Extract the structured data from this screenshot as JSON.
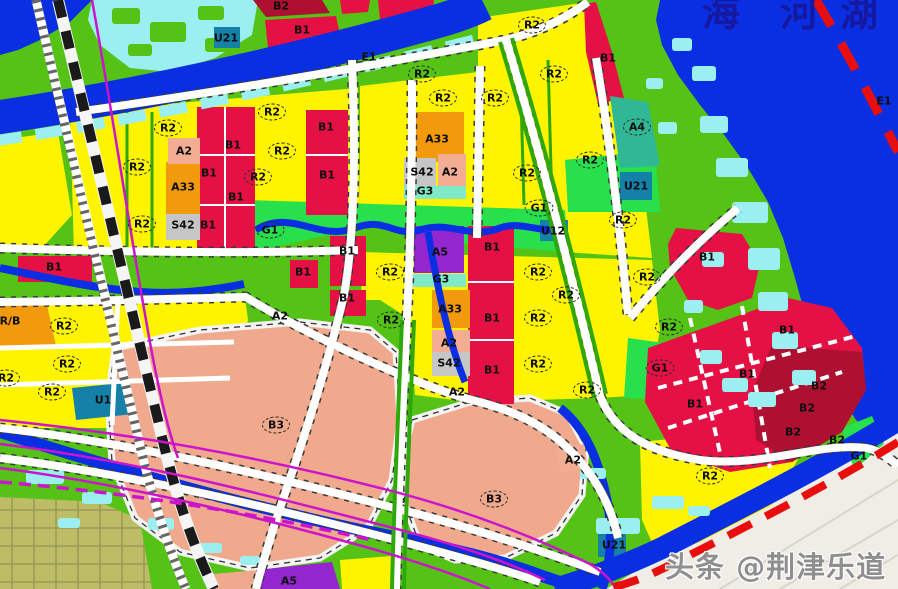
{
  "map": {
    "watermark": "头条 @荆津乐道",
    "lake": {
      "name_chars": [
        "海",
        "河",
        "湖"
      ]
    },
    "palette": {
      "residential_R2": "#FEF400",
      "commercial_B1": "#E51144",
      "commercial_B2": "#AD1030",
      "recreation_B3": "#F0A98C",
      "culture_A2": "#F3AD92",
      "education_A33": "#F29A0D",
      "sports_A4": "#30B896",
      "special_A5": "#9326CE",
      "parking_S42": "#C6C6C6",
      "park_G1": "#28E04C",
      "green_G3": "#7FE9C8",
      "utility_U": "#1580A8",
      "water_E1": "#0A2FE2",
      "pond_cyan": "#9CEFF0",
      "land_green": "#54C316",
      "farmland_khaki": "#BDBD68",
      "boundary_red": "#E80E0E",
      "utility_magenta": "#CC14CC"
    },
    "zone_labels": [
      {
        "text": "B2",
        "x": 281,
        "y": 6
      },
      {
        "text": "B1",
        "x": 302,
        "y": 30
      },
      {
        "text": "U21",
        "x": 226,
        "y": 38
      },
      {
        "text": "E1",
        "x": 369,
        "y": 57
      },
      {
        "text": "R2",
        "x": 532,
        "y": 25,
        "circled": true
      },
      {
        "text": "R2",
        "x": 422,
        "y": 74,
        "circled": true
      },
      {
        "text": "R2",
        "x": 554,
        "y": 74,
        "circled": true
      },
      {
        "text": "B1",
        "x": 608,
        "y": 58
      },
      {
        "text": "A4",
        "x": 637,
        "y": 127,
        "circled": true
      },
      {
        "text": "R2",
        "x": 272,
        "y": 112,
        "circled": true
      },
      {
        "text": "R2",
        "x": 168,
        "y": 128,
        "circled": true
      },
      {
        "text": "B1",
        "x": 233,
        "y": 145
      },
      {
        "text": "A2",
        "x": 184,
        "y": 151
      },
      {
        "text": "R2",
        "x": 282,
        "y": 151,
        "circled": true
      },
      {
        "text": "B1",
        "x": 326,
        "y": 127
      },
      {
        "text": "R2",
        "x": 137,
        "y": 167,
        "circled": true
      },
      {
        "text": "B1",
        "x": 209,
        "y": 173
      },
      {
        "text": "A33",
        "x": 183,
        "y": 187
      },
      {
        "text": "R2",
        "x": 258,
        "y": 177,
        "circled": true
      },
      {
        "text": "B1",
        "x": 236,
        "y": 197
      },
      {
        "text": "B1",
        "x": 327,
        "y": 175
      },
      {
        "text": "R2",
        "x": 443,
        "y": 98,
        "circled": true
      },
      {
        "text": "R2",
        "x": 495,
        "y": 98,
        "circled": true
      },
      {
        "text": "A33",
        "x": 437,
        "y": 139
      },
      {
        "text": "S42",
        "x": 422,
        "y": 172
      },
      {
        "text": "A2",
        "x": 450,
        "y": 172
      },
      {
        "text": "G3",
        "x": 425,
        "y": 191
      },
      {
        "text": "R2",
        "x": 527,
        "y": 173,
        "circled": true
      },
      {
        "text": "R2",
        "x": 590,
        "y": 160,
        "circled": true
      },
      {
        "text": "U21",
        "x": 636,
        "y": 186
      },
      {
        "text": "E1",
        "x": 884,
        "y": 101
      },
      {
        "text": "R2",
        "x": 142,
        "y": 224,
        "circled": true
      },
      {
        "text": "S42",
        "x": 183,
        "y": 225
      },
      {
        "text": "B1",
        "x": 208,
        "y": 225
      },
      {
        "text": "G1",
        "x": 270,
        "y": 230,
        "circled": true
      },
      {
        "text": "G1",
        "x": 539,
        "y": 208,
        "circled": true
      },
      {
        "text": "U12",
        "x": 553,
        "y": 231
      },
      {
        "text": "R2",
        "x": 623,
        "y": 220,
        "circled": true
      },
      {
        "text": "B1",
        "x": 54,
        "y": 267
      },
      {
        "text": "B1",
        "x": 303,
        "y": 272
      },
      {
        "text": "B1",
        "x": 347,
        "y": 251
      },
      {
        "text": "A5",
        "x": 440,
        "y": 252
      },
      {
        "text": "B1",
        "x": 492,
        "y": 247
      },
      {
        "text": "R2",
        "x": 390,
        "y": 272,
        "circled": true
      },
      {
        "text": "R2",
        "x": 538,
        "y": 272,
        "circled": true
      },
      {
        "text": "R2",
        "x": 647,
        "y": 277,
        "circled": true
      },
      {
        "text": "G3",
        "x": 441,
        "y": 279
      },
      {
        "text": "B1",
        "x": 707,
        "y": 257
      },
      {
        "text": "B1",
        "x": 347,
        "y": 298
      },
      {
        "text": "A33",
        "x": 450,
        "y": 309
      },
      {
        "text": "R2",
        "x": 391,
        "y": 320,
        "circled": true
      },
      {
        "text": "B1",
        "x": 492,
        "y": 318
      },
      {
        "text": "R2",
        "x": 538,
        "y": 318,
        "circled": true
      },
      {
        "text": "R2",
        "x": 566,
        "y": 295,
        "circled": true
      },
      {
        "text": "R/B",
        "x": 10,
        "y": 321
      },
      {
        "text": "R2",
        "x": 64,
        "y": 326,
        "circled": true
      },
      {
        "text": "A2",
        "x": 280,
        "y": 316
      },
      {
        "text": "A2",
        "x": 449,
        "y": 343
      },
      {
        "text": "S42",
        "x": 449,
        "y": 363
      },
      {
        "text": "B1",
        "x": 492,
        "y": 370
      },
      {
        "text": "R2",
        "x": 538,
        "y": 364,
        "circled": true
      },
      {
        "text": "R2",
        "x": 587,
        "y": 390,
        "circled": true
      },
      {
        "text": "R2",
        "x": 669,
        "y": 327,
        "circled": true
      },
      {
        "text": "G1",
        "x": 660,
        "y": 368,
        "circled": true
      },
      {
        "text": "B1",
        "x": 787,
        "y": 330
      },
      {
        "text": "R2",
        "x": 67,
        "y": 364,
        "circled": true
      },
      {
        "text": "R2",
        "x": 6,
        "y": 378,
        "circled": true
      },
      {
        "text": "R2",
        "x": 52,
        "y": 392,
        "circled": true
      },
      {
        "text": "U1",
        "x": 103,
        "y": 400
      },
      {
        "text": "B3",
        "x": 276,
        "y": 425,
        "circled": true
      },
      {
        "text": "A2",
        "x": 457,
        "y": 392
      },
      {
        "text": "B1",
        "x": 747,
        "y": 374
      },
      {
        "text": "B2",
        "x": 819,
        "y": 386
      },
      {
        "text": "B1",
        "x": 695,
        "y": 404
      },
      {
        "text": "B2",
        "x": 807,
        "y": 408
      },
      {
        "text": "B2",
        "x": 793,
        "y": 432
      },
      {
        "text": "B2",
        "x": 837,
        "y": 440
      },
      {
        "text": "G1",
        "x": 859,
        "y": 456
      },
      {
        "text": "A2",
        "x": 573,
        "y": 460
      },
      {
        "text": "R2",
        "x": 710,
        "y": 476,
        "circled": true
      },
      {
        "text": "B3",
        "x": 494,
        "y": 499,
        "circled": true
      },
      {
        "text": "U21",
        "x": 614,
        "y": 545
      },
      {
        "text": "A5",
        "x": 289,
        "y": 581
      }
    ]
  }
}
